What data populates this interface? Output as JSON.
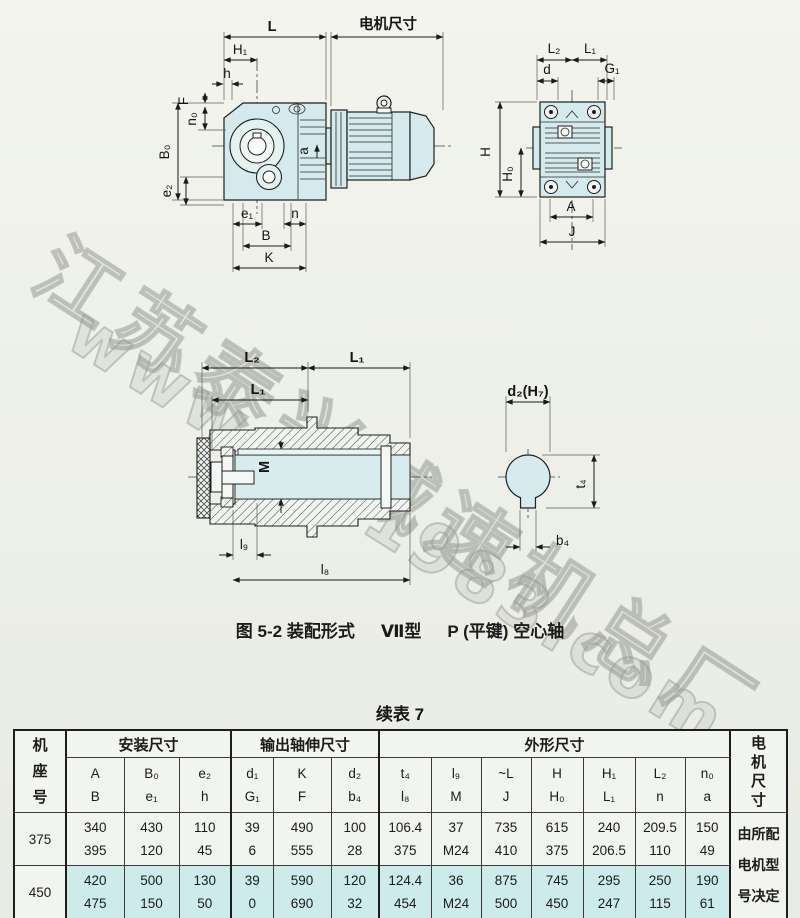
{
  "watermark": {
    "line1": "江苏泰兴减速机总厂",
    "line2": "www.tx-1983.com"
  },
  "caption": {
    "figure": "图 5-2 装配形式",
    "type": "Ⅶ型",
    "shaft": "P (平键) 空心轴"
  },
  "colors": {
    "highlight": "#cdebeb",
    "drawing_fill": "#d5eaec",
    "paper": "#edf0e8"
  },
  "dwg": {
    "side": {
      "L": "L",
      "motor": "电机尺寸",
      "H1": "H₁",
      "h": "h",
      "F": "F",
      "n0": "n₀",
      "B0": "B₀",
      "e2": "e₂",
      "a": "a",
      "e1": "e₁",
      "n": "n",
      "B": "B",
      "K": "K"
    },
    "front": {
      "L2": "L₂",
      "L1": "L₁",
      "d": "d",
      "G1": "G₁",
      "H": "H",
      "H0": "H₀",
      "A": "A",
      "J": "J"
    },
    "section": {
      "L2": "L₂",
      "L1a": "L₁",
      "L1b": "L₁",
      "M": "M",
      "l9": "l₉",
      "l8": "l₈"
    },
    "key": {
      "d2": "d₂(H₇)",
      "t4": "t₄",
      "b4": "b₄"
    }
  },
  "table": {
    "title": "续表 7",
    "machine_col": [
      "机",
      "座",
      "号"
    ],
    "motor_col": [
      "电",
      "机",
      "尺",
      "寸"
    ],
    "groups": [
      "安装尺寸",
      "输出轴伸尺寸",
      "外形尺寸"
    ],
    "sym": [
      [
        "A",
        "B"
      ],
      [
        "B₀",
        "e₁"
      ],
      [
        "e₂",
        "h"
      ],
      [
        "d₁",
        "G₁"
      ],
      [
        "K",
        "F"
      ],
      [
        "d₂",
        "b₄"
      ],
      [
        "t₄",
        "l₈"
      ],
      [
        "l₉",
        "M"
      ],
      [
        "~L",
        "J"
      ],
      [
        "H",
        "H₀"
      ],
      [
        "H₁",
        "L₁"
      ],
      [
        "L₂",
        "n"
      ],
      [
        "n₀",
        "a"
      ]
    ],
    "rows": [
      {
        "size": "375",
        "values": [
          [
            "340",
            "395"
          ],
          [
            "430",
            "120"
          ],
          [
            "110",
            "45"
          ],
          [
            "39",
            "6"
          ],
          [
            "490",
            "555"
          ],
          [
            "100",
            "28"
          ],
          [
            "106.4",
            "375"
          ],
          [
            "37",
            "M24"
          ],
          [
            "735",
            "410"
          ],
          [
            "615",
            "375"
          ],
          [
            "240",
            "206.5"
          ],
          [
            "209.5",
            "110"
          ],
          [
            "150",
            "49"
          ]
        ]
      },
      {
        "size": "450",
        "values": [
          [
            "420",
            "475"
          ],
          [
            "500",
            "150"
          ],
          [
            "130",
            "50"
          ],
          [
            "39",
            "0"
          ],
          [
            "590",
            "690"
          ],
          [
            "120",
            "32"
          ],
          [
            "124.4",
            "454"
          ],
          [
            "36",
            "M24"
          ],
          [
            "875",
            "500"
          ],
          [
            "745",
            "450"
          ],
          [
            "295",
            "247"
          ],
          [
            "250",
            "115"
          ],
          [
            "190",
            "61"
          ]
        ]
      }
    ],
    "motor_note": [
      "由所配",
      "电机型",
      "号决定"
    ]
  }
}
